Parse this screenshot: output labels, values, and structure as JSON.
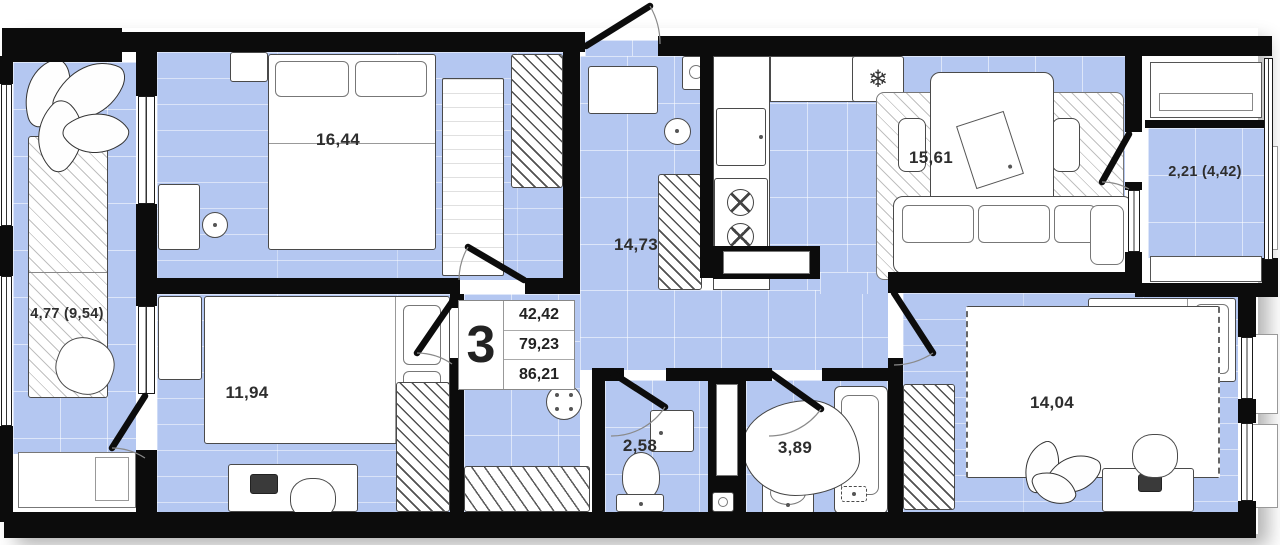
{
  "info_box": {
    "rooms_count": "3",
    "values": {
      "v1": "42,42",
      "v2": "79,23",
      "v3": "86,21"
    }
  },
  "rooms": {
    "bedroom_top_left": {
      "area": "16,44"
    },
    "bedroom_bottom_left": {
      "area": "11,94"
    },
    "hall": {
      "area": "14,73"
    },
    "kitchen_living": {
      "area": "15,61"
    },
    "bedroom_bottom_right": {
      "area": "14,04"
    },
    "wc": {
      "area": "2,58"
    },
    "bathroom": {
      "area": "3,89"
    },
    "loggia_left": {
      "area": "4,77 (9,54)"
    },
    "balcony_right": {
      "area": "2,21 (4,42)"
    }
  },
  "icons": {
    "fridge_snowflake": "❄"
  },
  "colors": {
    "floor": "#b4c7f1",
    "wall": "#0c0c0c",
    "furniture_outline": "#4a4a4a",
    "background": "#ffffff"
  }
}
